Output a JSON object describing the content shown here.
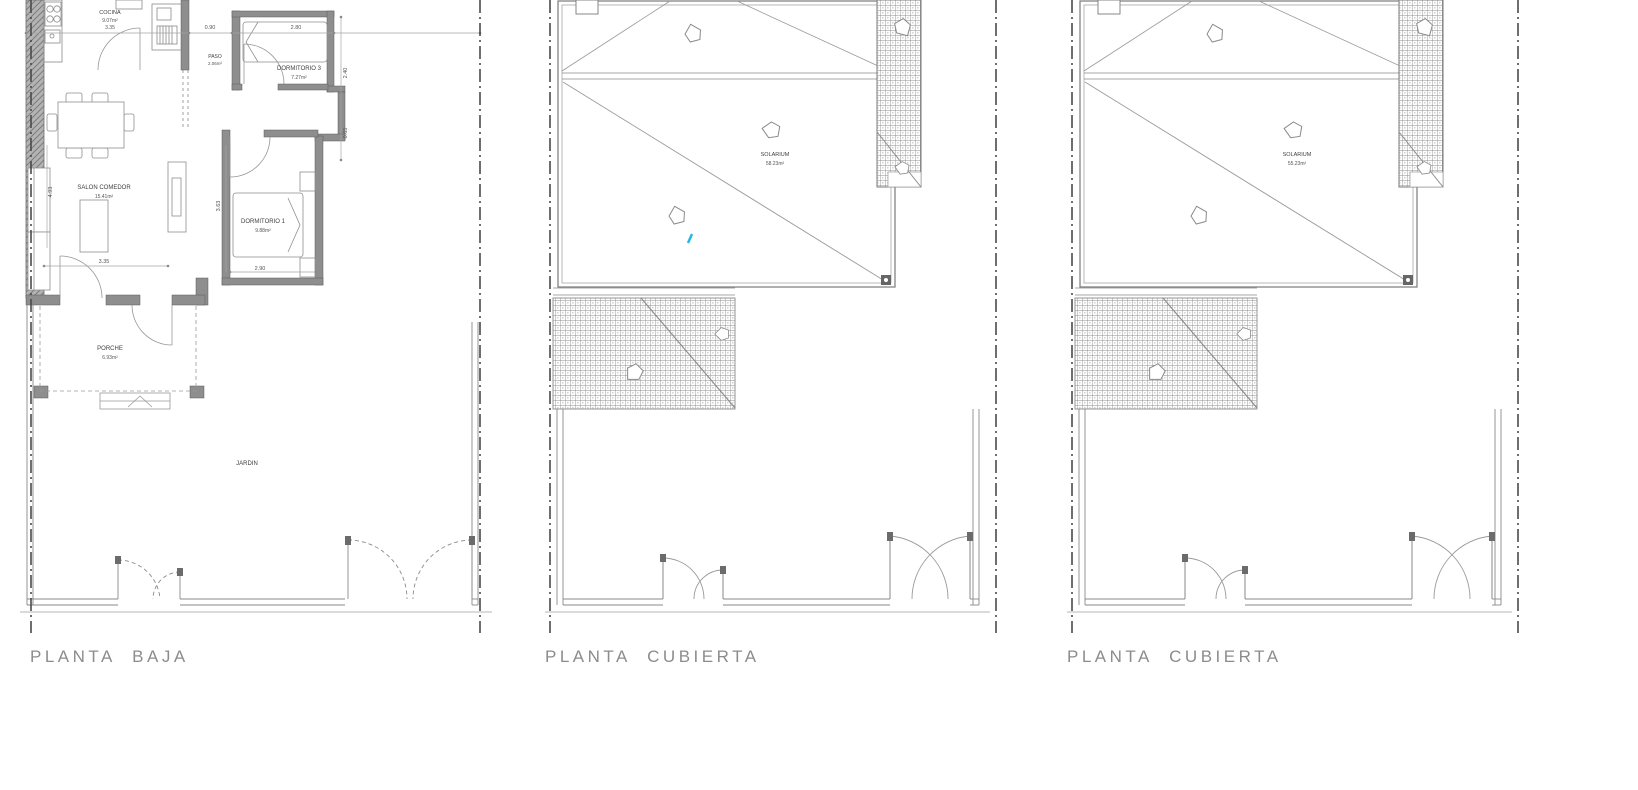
{
  "document": {
    "type": "architectural-plan-scan",
    "sheet_titles": [
      "PLANTA BAJA",
      "PLANTA CUBIERTA",
      "PLANTA CUBIERTA"
    ]
  },
  "panels": {
    "planta_baja": {
      "title": "PLANTA BAJA",
      "rooms": {
        "cocina": {
          "name": "COCINA",
          "area": "9.07m²",
          "dim": "3.35"
        },
        "paso": {
          "name": "PASO",
          "area": "2.06m²"
        },
        "dormitorio3": {
          "name": "DORMITORIO 3",
          "area": "7.27m²"
        },
        "salon_comedor": {
          "name": "SALON COMEDOR",
          "area": "15.41m²"
        },
        "dormitorio1": {
          "name": "DORMITORIO 1",
          "area": "9.88m²"
        },
        "porche": {
          "name": "PORCHE",
          "area": "6.93m²"
        },
        "jardin": {
          "name": "JARDIN"
        }
      },
      "dimensions": {
        "paso_width": "0.90",
        "dorm3_width": "2.80",
        "dorm3_depth": "2.40",
        "wall_jog": "0.65",
        "salon_depth": "4.93",
        "salon_width": "3.35",
        "dorm1_depth": "3.63",
        "dorm1_width": "2.90"
      }
    },
    "planta_cubierta_center": {
      "title": "PLANTA CUBIERTA",
      "rooms": {
        "solarium": {
          "name": "SOLARIUM",
          "area": "58.23m²"
        }
      }
    },
    "planta_cubierta_right": {
      "title": "PLANTA CUBIERTA",
      "rooms": {
        "solarium": {
          "name": "SOLARIUM",
          "area": "55.23m²"
        }
      }
    }
  },
  "colors": {
    "paper": "#ffffff",
    "wall_fill": "#8e8e8e",
    "line": "#8a8a8a",
    "boundary": "#4a4a4a",
    "title_text": "#8c8c8c",
    "label_text": "#3f3f3f",
    "annotation_mark": "#2ab5e8"
  }
}
